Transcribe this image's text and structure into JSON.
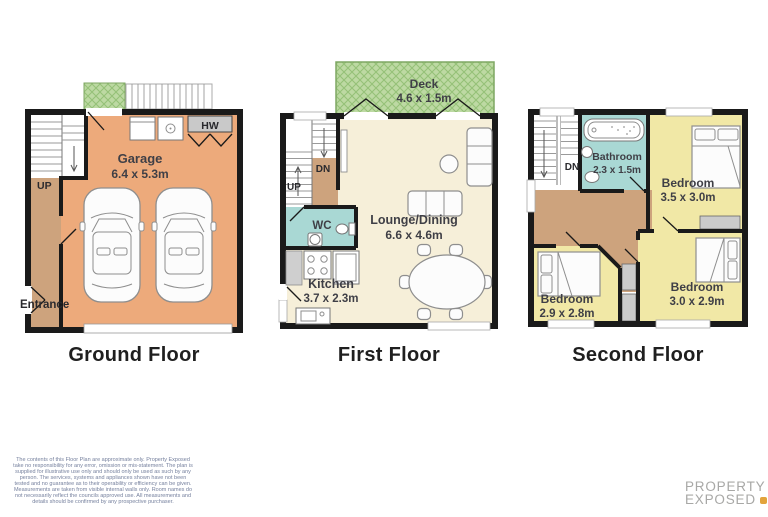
{
  "colors": {
    "wall": "#1a1a1a",
    "garage_floor": "#edaa7b",
    "hall_floor": "#cda37d",
    "lounge_floor": "#f6efd9",
    "bedroom_floor": "#f1e8a6",
    "wet_room_floor": "#a9d8d4",
    "deck_green": "#bdd9a3",
    "closet_gray": "#cbcbcb",
    "room_label": "#3f3f46",
    "title_text": "#1f1f1f",
    "disclaimer_text": "#76819e",
    "logo_text": "#a8a8a6",
    "logo_accent": "#e2a33c"
  },
  "ground": {
    "title": "Ground Floor",
    "garage": "Garage",
    "garage_dims": "6.4 x 5.3m",
    "up": "UP",
    "hw": "HW",
    "entrance": "Entrance"
  },
  "first": {
    "title": "First Floor",
    "deck": "Deck",
    "deck_dims": "4.6 x 1.5m",
    "lounge": "Lounge/Dining",
    "lounge_dims": "6.6 x 4.6m",
    "wc": "WC",
    "kitchen": "Kitchen",
    "kitchen_dims": "3.7 x 2.3m",
    "dn": "DN",
    "up": "UP"
  },
  "second": {
    "title": "Second Floor",
    "bathroom": "Bathroom",
    "bathroom_dims": "2.3 x 1.5m",
    "bedroom_tr": "Bedroom",
    "bedroom_tr_dims": "3.5 x 3.0m",
    "bedroom_bl": "Bedroom",
    "bedroom_bl_dims": "2.9 x 2.8m",
    "bedroom_br": "Bedroom",
    "bedroom_br_dims": "3.0 x 2.9m",
    "dn": "DN"
  },
  "footer": {
    "disclaimer": "The contents of this Floor Plan are approximate only. Property Exposed take no responsibility for any error, omission or mis-statement. The plan is supplied for illustrative use only and should only be used as such by any person. The services, systems and appliances shown have not been tested and no guarantee as to their operability or efficiency can be given. Measurements are taken from visible internal walls only. Room names do not necessarily reflect the councils approved use. All measurements and details should be confirmed by any prospective purchaser.",
    "logo_line1": "PROPERTY",
    "logo_line2": "EXPOSED"
  }
}
